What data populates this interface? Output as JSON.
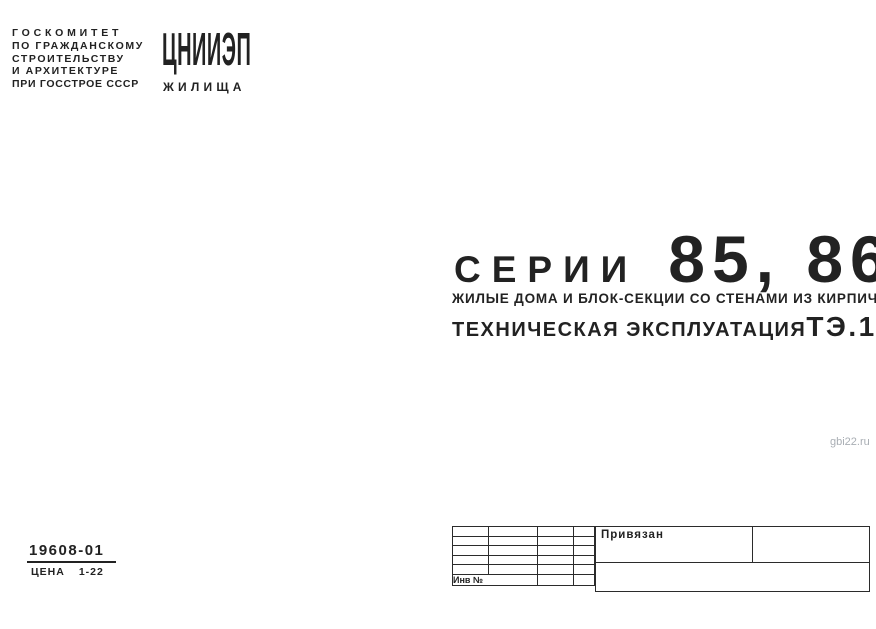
{
  "header": {
    "committee_lines": [
      "ГОСКОМИТЕТ",
      "ПО ГРАЖДАНСКОМУ",
      "СТРОИТЕЛЬСТВУ",
      "И АРХИТЕКТУРЕ",
      "ПРИ ГОССТРОЕ СССР"
    ],
    "logo": {
      "name": "ЦНИИЭП",
      "sub": "ЖИЛИЩА"
    }
  },
  "title": {
    "series_label": "СЕРИИ",
    "series_numbers": "85, 86",
    "subtitle": "ЖИЛЫЕ ДОМА И БЛОК-СЕКЦИИ СО СТЕНАМИ ИЗ КИРПИЧА",
    "doc_type": "ТЕХНИЧЕСКАЯ ЭКСПЛУАТАЦИЯ",
    "doc_code": "ТЭ.1"
  },
  "footer": {
    "catalog_number": "19608-01",
    "price_label": "ЦЕНА",
    "price_value": "1-22"
  },
  "title_block": {
    "annotation": "Привязан",
    "inventory_label": "Инв №"
  },
  "watermark": "gbi22.ru",
  "colors": {
    "ink": "#222222",
    "paper": "#ffffff",
    "watermark_gray": "#a9aeb4"
  }
}
